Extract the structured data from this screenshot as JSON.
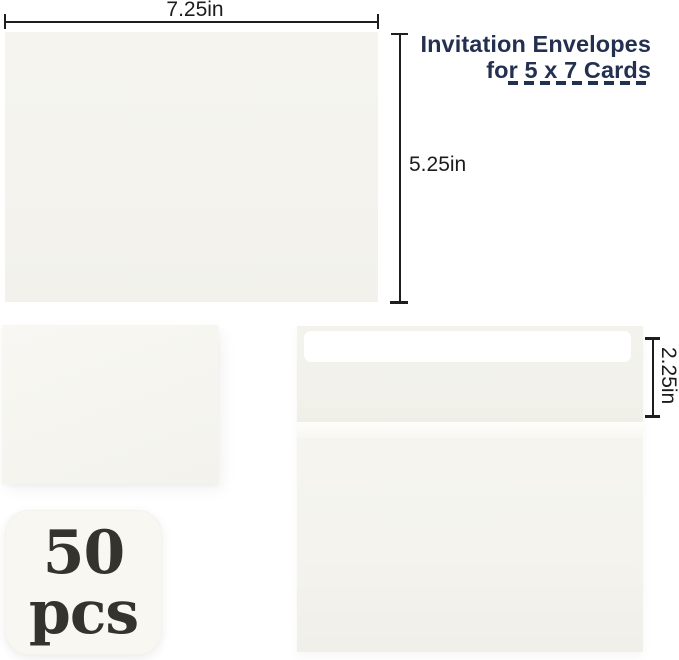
{
  "header": {
    "title_line1": "Invitation Envelopes",
    "title_line2": "for 5 x 7 Cards"
  },
  "dimensions": {
    "envelope_width": "7.25in",
    "envelope_height": "5.25in",
    "flap_height": "2.25in"
  },
  "quantity_badge": {
    "count": "50",
    "unit": "pcs"
  },
  "colors": {
    "title_navy": "#24304f",
    "dimension_line": "#1e1e1e",
    "envelope_paper": "#f4f3ee",
    "envelope_flap": "#f3f2ec",
    "seal_strip": "#ffffff",
    "badge_fill": "#f8f7f2",
    "badge_text": "#34332e",
    "background": "#ffffff"
  }
}
